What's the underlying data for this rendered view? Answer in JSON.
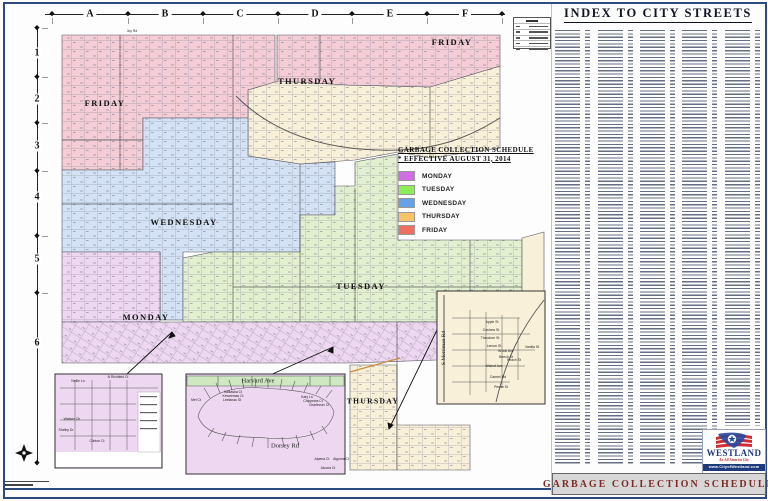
{
  "street_index": {
    "title": "INDEX TO CITY STREETS",
    "columns": 5
  },
  "footer": {
    "bottom_bar_title": "GARBAGE COLLECTION SCHEDULE"
  },
  "rulers": {
    "columns": [
      "A",
      "B",
      "C",
      "D",
      "E",
      "F"
    ],
    "rows": [
      "1",
      "2",
      "3",
      "4",
      "5",
      "6"
    ]
  },
  "legend": {
    "title": "GARBAGE COLLECTION SCHEDULE",
    "subtitle": "* EFFECTIVE AUGUST 31, 2014",
    "items": [
      {
        "label": "MONDAY",
        "color": "#d16de2"
      },
      {
        "label": "TUESDAY",
        "color": "#8ced58"
      },
      {
        "label": "WEDNESDAY",
        "color": "#66a1e8"
      },
      {
        "label": "THURSDAY",
        "color": "#f7c468"
      },
      {
        "label": "FRIDAY",
        "color": "#ee6f5e"
      }
    ]
  },
  "map": {
    "zone_fills": {
      "monday": "#eed7f1",
      "tuesday": "#e3f0d0",
      "wednesday": "#d3e2f4",
      "thursday": "#f8f0d8",
      "friday": "#f4cdd6"
    },
    "zone_labels": [
      {
        "id": "friday-west",
        "label": "FRIDAY"
      },
      {
        "id": "thursday-north",
        "label": "THURSDAY"
      },
      {
        "id": "friday-northeast",
        "label": "FRIDAY"
      },
      {
        "id": "wednesday",
        "label": "WEDNESDAY"
      },
      {
        "id": "monday",
        "label": "MONDAY"
      },
      {
        "id": "tuesday",
        "label": "TUESDAY"
      },
      {
        "id": "thursday-south",
        "label": "THURSDAY"
      }
    ],
    "roads": {
      "north_boundary": "Joy Rd"
    },
    "insets": {
      "southwest_detail": {
        "streets": [
          "Nellie Ln",
          "N Richfield Ct",
          "Watson Cir",
          "Shelby Dr",
          "Clinton Ct"
        ]
      },
      "south_detail": {
        "top_street": "Harvard Ave",
        "main_street": "Dorsey Rd",
        "streets": [
          "Kalkaska Ct",
          "Keweenaw Ct",
          "Leelanau St",
          "Mel Ct",
          "Katy Ln",
          "Chippewa Ct",
          "Charlevoix Ct",
          "Alpena Ct",
          "Algoma Ct",
          "Alcona Ct"
        ]
      },
      "merriman_detail": {
        "side_street": "S Merriman Rd",
        "streets": [
          "Apple St",
          "Cashew St",
          "Theodore St",
          "Lemon St",
          "Brook Ave",
          "Beech St",
          "Peach St",
          "Walnut Ave",
          "Carmel Rd",
          "Pecan St",
          "Vanilla St"
        ]
      }
    }
  },
  "logo": {
    "name": "WESTLAND",
    "tagline": "An All America City",
    "website": "www.CityofWestland.com"
  }
}
